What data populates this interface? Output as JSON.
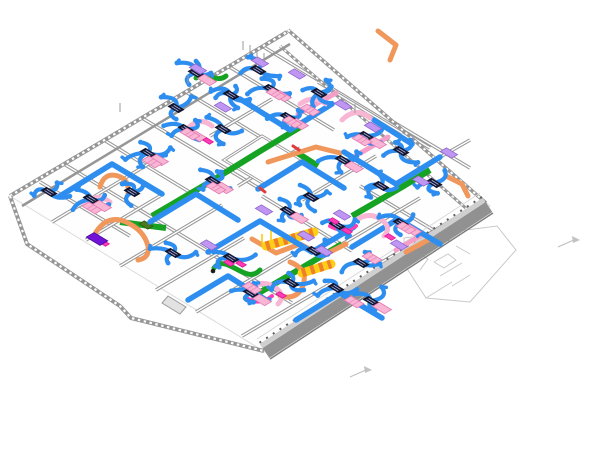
{
  "view": {
    "type": "3d-isometric-bim-mep-model",
    "width": 600,
    "height": 471,
    "background": "#ffffff"
  },
  "systems": [
    {
      "name": "flex-duct-supply",
      "color": "#2e8ef0"
    },
    {
      "name": "slot-diffuser-box",
      "color": "#14162e",
      "slot_color": "#aab4e8"
    },
    {
      "name": "hydronic-pipe-green",
      "color": "#16a323"
    },
    {
      "name": "conduit-orange",
      "color": "#f0975c"
    },
    {
      "name": "insulated-flex-duct",
      "color": "#ffcf18",
      "stripe": "#ef7f28"
    },
    {
      "name": "fan-coil-unit-pink",
      "color": "#f8b6d4",
      "stripe": "#ec8fc0",
      "edge": "#e277b2"
    },
    {
      "name": "vav-box-purple",
      "color": "#bf97f2",
      "edge": "#8f62cc"
    },
    {
      "name": "equipment-dark-purple",
      "color": "#7212d6",
      "edge": "#4d0a9e"
    },
    {
      "name": "accent-magenta",
      "color": "#ff3db2",
      "edge": "#d9179a"
    },
    {
      "name": "pink-duct-main",
      "color": "#f49fc8"
    },
    {
      "name": "equipment-olive",
      "color": "#4a7a1e",
      "edge": "#33550f"
    },
    {
      "name": "accent-red",
      "color": "#e03c3c"
    },
    {
      "name": "walls",
      "color": "#969696",
      "light": "#ffffff"
    },
    {
      "name": "parapet-band",
      "color": "#919191",
      "top": "#cfcfcf",
      "edge": "#7e7e7e"
    },
    {
      "name": "faint-outline",
      "color": "#c9c9c9"
    }
  ],
  "scene": {
    "floor": {
      "points": [
        [
          10,
          196
        ],
        [
          288,
          30
        ],
        [
          490,
          206
        ],
        [
          265,
          352
        ]
      ],
      "fill": "#fefefe",
      "edge": "#dcdcdc"
    },
    "shaft": {
      "points": [
        [
          224,
          160
        ],
        [
          262,
          136
        ],
        [
          302,
          160
        ],
        [
          264,
          184
        ]
      ],
      "fill": "#ffffff"
    },
    "walls_interior": [
      {
        "pts": [
          [
            64,
            164
          ],
          [
            206,
            250
          ]
        ]
      },
      {
        "pts": [
          [
            104,
            140
          ],
          [
            196,
            196
          ]
        ]
      },
      {
        "pts": [
          [
            142,
            118
          ],
          [
            262,
            190
          ]
        ]
      },
      {
        "pts": [
          [
            186,
            92
          ],
          [
            300,
            161
          ]
        ]
      },
      {
        "pts": [
          [
            228,
            66
          ],
          [
            334,
            130
          ]
        ]
      },
      {
        "pts": [
          [
            262,
            46
          ],
          [
            430,
            148
          ]
        ]
      },
      {
        "pts": [
          [
            318,
            82
          ],
          [
            402,
            133
          ]
        ]
      },
      {
        "pts": [
          [
            40,
            182
          ],
          [
            130,
            236
          ]
        ]
      },
      {
        "pts": [
          [
            208,
            252
          ],
          [
            292,
            303
          ]
        ]
      },
      {
        "pts": [
          [
            262,
            196
          ],
          [
            352,
            251
          ]
        ]
      },
      {
        "pts": [
          [
            360,
            186
          ],
          [
            450,
            240
          ]
        ]
      },
      {
        "pts": [
          [
            390,
            120
          ],
          [
            470,
            168
          ]
        ]
      },
      {
        "pts": [
          [
            52,
            222
          ],
          [
            150,
            163
          ]
        ]
      },
      {
        "pts": [
          [
            86,
            240
          ],
          [
            160,
            196
          ]
        ]
      },
      {
        "pts": [
          [
            120,
            266
          ],
          [
            222,
            205
          ]
        ]
      },
      {
        "pts": [
          [
            156,
            290
          ],
          [
            244,
            238
          ]
        ]
      },
      {
        "pts": [
          [
            196,
            312
          ],
          [
            300,
            250
          ]
        ]
      },
      {
        "pts": [
          [
            242,
            336
          ],
          [
            330,
            284
          ]
        ]
      },
      {
        "pts": [
          [
            160,
            108
          ],
          [
            226,
            68
          ]
        ]
      },
      {
        "pts": [
          [
            210,
            136
          ],
          [
            272,
            99
          ]
        ]
      },
      {
        "pts": [
          [
            238,
            186
          ],
          [
            300,
            148
          ]
        ]
      },
      {
        "pts": [
          [
            302,
            200
          ],
          [
            376,
            156
          ]
        ]
      },
      {
        "pts": [
          [
            332,
            250
          ],
          [
            420,
            198
          ]
        ]
      },
      {
        "pts": [
          [
            382,
            262
          ],
          [
            462,
            214
          ]
        ]
      },
      {
        "pts": [
          [
            414,
            172
          ],
          [
            470,
            140
          ]
        ]
      }
    ],
    "walls_perimeter": [
      {
        "pts": [
          [
            10,
            196
          ],
          [
            287,
            32
          ]
        ],
        "w": 4,
        "studs": true
      },
      {
        "pts": [
          [
            288,
            30
          ],
          [
            486,
            203
          ]
        ],
        "w": 3.5,
        "studs": true
      },
      {
        "pts": [
          [
            280,
            46
          ],
          [
            468,
            210
          ]
        ],
        "w": 3,
        "studs": true
      },
      {
        "pts": [
          [
            22,
            206
          ],
          [
            290,
            44
          ]
        ],
        "w": 2.5,
        "studs": false
      },
      {
        "pts": [
          [
            10,
            196
          ],
          [
            27,
            244
          ],
          [
            120,
            306
          ],
          [
            131,
            318
          ],
          [
            264,
            351
          ]
        ],
        "w": 4,
        "studs": true
      }
    ],
    "parapet": {
      "top_light": {
        "pts": [
          [
            484,
            200
          ],
          [
            261,
            346
          ]
        ],
        "w": 5,
        "color": "#cfcfcf"
      },
      "band": {
        "pts": [
          [
            489,
            207
          ],
          [
            266,
            353
          ]
        ],
        "w": 12,
        "color": "#919191"
      },
      "dark_edge": {
        "pts": [
          [
            493,
            213
          ],
          [
            270,
            359
          ]
        ],
        "w": 1.5,
        "color": "#7e7e7e"
      },
      "inner_ticks": {
        "pts": [
          [
            482,
            197
          ],
          [
            259,
            343
          ]
        ],
        "w": 2,
        "color": "#5f5f5f",
        "dash": "2,6"
      },
      "floor_line": {
        "pts": [
          [
            480,
            193
          ],
          [
            257,
            339
          ]
        ],
        "w": 1,
        "color": "#d8d8d8"
      }
    },
    "stub": {
      "points": [
        [
          168,
          296
        ],
        [
          186,
          307
        ],
        [
          180,
          314
        ],
        [
          162,
          303
        ]
      ],
      "fill": "#e2e2e2",
      "edge": "#9a9a9a"
    },
    "pipes_green": [
      [
        [
          152,
          216
        ],
        [
          210,
          182
        ],
        [
          262,
          150
        ],
        [
          302,
          126
        ]
      ],
      [
        [
          252,
          297
        ],
        [
          300,
          269
        ],
        [
          342,
          244
        ]
      ],
      [
        [
          352,
          216
        ],
        [
          402,
          187
        ],
        [
          430,
          170
        ]
      ],
      [
        [
          120,
          222
        ],
        [
          166,
          228
        ]
      ],
      [
        [
          296,
          152
        ],
        [
          318,
          166
        ]
      ]
    ],
    "green_curls": [
      "M214,268 C226,252 246,286 260,270",
      "M196,78 C206,70 216,84 226,76"
    ],
    "olive_boxes": [
      [
        146,
        225
      ]
    ],
    "pipes_orange": [
      [
        [
          268,
          162
        ],
        [
          316,
          147
        ],
        [
          340,
          153
        ]
      ],
      [
        [
          252,
          239
        ],
        [
          276,
          253
        ],
        [
          300,
          244
        ],
        [
          322,
          256
        ],
        [
          346,
          244
        ]
      ],
      [
        [
          378,
          31
        ],
        [
          396,
          45
        ],
        [
          390,
          60
        ]
      ],
      [
        [
          446,
          176
        ],
        [
          462,
          184
        ],
        [
          468,
          196
        ]
      ],
      [
        [
          406,
          252
        ],
        [
          428,
          240
        ]
      ]
    ],
    "orange_curls": [
      "M96,232 Q108,214 126,222 Q144,230 148,246 Q150,258 138,260",
      "M290,262 Q310,270 302,288 Q296,300 280,296",
      "M100,187 Q104,172 118,176 Q130,180 128,194"
    ],
    "pink_mains": [
      [
        [
          298,
          114
        ],
        [
          336,
          93
        ]
      ],
      [
        [
          352,
          158
        ],
        [
          388,
          137
        ]
      ],
      [
        [
          396,
          250
        ],
        [
          420,
          236
        ]
      ]
    ],
    "striped_ducts": [
      [
        [
          266,
          246
        ],
        [
          314,
          232
        ]
      ],
      [
        [
          302,
          273
        ],
        [
          331,
          264
        ]
      ]
    ],
    "hangers": [
      [
        262,
        234,
        262,
        246
      ],
      [
        271,
        230,
        271,
        242
      ]
    ],
    "pipes_blue": [
      [
        [
          60,
          196
        ],
        [
          112,
          164
        ],
        [
          162,
          194
        ]
      ],
      [
        [
          240,
          99
        ],
        [
          290,
          130
        ],
        [
          332,
          104
        ]
      ],
      [
        [
          344,
          152
        ],
        [
          396,
          184
        ],
        [
          440,
          157
        ]
      ],
      [
        [
          208,
          252
        ],
        [
          260,
          221
        ],
        [
          312,
          252
        ],
        [
          354,
          227
        ]
      ],
      [
        [
          258,
          189
        ],
        [
          302,
          162
        ],
        [
          344,
          188
        ]
      ],
      [
        [
          352,
          247
        ],
        [
          398,
          219
        ],
        [
          440,
          244
        ]
      ],
      [
        [
          150,
          222
        ],
        [
          196,
          194
        ],
        [
          238,
          220
        ]
      ],
      [
        [
          296,
          320
        ],
        [
          340,
          293
        ],
        [
          382,
          318
        ]
      ],
      [
        [
          374,
          120
        ],
        [
          412,
          144
        ]
      ],
      [
        [
          188,
          300
        ],
        [
          228,
          276
        ],
        [
          266,
          300
        ]
      ]
    ],
    "pink_flex": [
      "M250,290 Q262,278 276,288 Q286,296 278,304",
      "M188,128 Q200,116 212,126",
      "M354,222 Q368,210 382,220 Q392,228 384,236",
      "M342,120 Q356,106 370,118",
      "M84,204 Q96,192 110,202",
      "M300,104 Q314,94 326,104"
    ],
    "magenta_flex": [
      "M246,298 Q260,306 272,296",
      "M330,226 Q344,234 356,226"
    ],
    "clusters": [
      [
        196,
        73,
        4,
        "p"
      ],
      [
        231,
        95,
        5,
        ""
      ],
      [
        186,
        129,
        4,
        "p"
      ],
      [
        148,
        153,
        5,
        "p"
      ],
      [
        91,
        199,
        4,
        "p"
      ],
      [
        49,
        192,
        3,
        ""
      ],
      [
        176,
        108,
        3,
        ""
      ],
      [
        271,
        89,
        3,
        "p"
      ],
      [
        288,
        117,
        3,
        "p"
      ],
      [
        319,
        93,
        5,
        ""
      ],
      [
        366,
        136,
        3,
        "p"
      ],
      [
        401,
        151,
        4,
        ""
      ],
      [
        381,
        186,
        4,
        ""
      ],
      [
        311,
        197,
        4,
        ""
      ],
      [
        401,
        223,
        4,
        "p"
      ],
      [
        337,
        225,
        3,
        "m"
      ],
      [
        213,
        181,
        4,
        "p"
      ],
      [
        173,
        253,
        4,
        ""
      ],
      [
        231,
        258,
        3,
        "m"
      ],
      [
        251,
        293,
        4,
        "p"
      ],
      [
        291,
        283,
        4,
        ""
      ],
      [
        361,
        263,
        3,
        ""
      ],
      [
        371,
        301,
        3,
        "p"
      ],
      [
        336,
        288,
        3,
        ""
      ],
      [
        434,
        183,
        3,
        ""
      ],
      [
        223,
        129,
        3,
        ""
      ],
      [
        314,
        251,
        3,
        ""
      ],
      [
        132,
        192,
        3,
        ""
      ],
      [
        258,
        70,
        3,
        ""
      ],
      [
        343,
        160,
        3,
        "p"
      ],
      [
        288,
        211,
        3,
        "p"
      ]
    ],
    "pink_units": [
      [
        152,
        162
      ],
      [
        92,
        208
      ],
      [
        190,
        134
      ],
      [
        276,
        94
      ],
      [
        292,
        122
      ],
      [
        362,
        140
      ],
      [
        406,
        228
      ],
      [
        354,
        302
      ],
      [
        216,
        188
      ],
      [
        252,
        288
      ],
      [
        310,
        110
      ],
      [
        372,
        258
      ]
    ],
    "purple_boxes": [
      [
        198,
        69
      ],
      [
        223,
        107
      ],
      [
        297,
        74
      ],
      [
        343,
        105
      ],
      [
        421,
        181
      ],
      [
        342,
        215
      ],
      [
        324,
        251
      ],
      [
        209,
        245
      ],
      [
        373,
        127
      ],
      [
        399,
        245
      ],
      [
        449,
        153
      ],
      [
        260,
        62
      ],
      [
        306,
        236
      ],
      [
        264,
        210
      ]
    ],
    "magenta_chips": [
      [
        390,
        237
      ],
      [
        334,
        221
      ],
      [
        229,
        263
      ],
      [
        281,
        295
      ],
      [
        208,
        141
      ],
      [
        104,
        243
      ]
    ],
    "dark_purple_box": [
      97,
      239
    ],
    "red_chips": [
      [
        293,
        146,
        299,
        150
      ],
      [
        260,
        188,
        265,
        192
      ]
    ],
    "black_dots": [
      [
        213,
        271
      ]
    ],
    "grid_ticks": [
      [
        243,
        50
      ],
      [
        250,
        54
      ],
      [
        257,
        58
      ],
      [
        264,
        62
      ],
      [
        120,
        112
      ],
      [
        188,
        84
      ],
      [
        355,
        113
      ]
    ],
    "markers": [
      {
        "line": [
          [
            558,
            247
          ],
          [
            576,
            239
          ]
        ],
        "flag": [
          [
            572,
            236
          ],
          [
            580,
            240
          ],
          [
            573,
            243
          ]
        ]
      },
      {
        "line": [
          [
            350,
            377
          ],
          [
            368,
            369
          ]
        ],
        "flag": [
          [
            364,
            366
          ],
          [
            372,
            370
          ],
          [
            365,
            373
          ]
        ]
      }
    ],
    "wing": {
      "outer": [
        [
          404,
          238
        ],
        [
          497,
          226
        ],
        [
          516,
          250
        ],
        [
          470,
          302
        ],
        [
          426,
          298
        ],
        [
          404,
          264
        ]
      ],
      "lines": [
        [
          [
            404,
            264
          ],
          [
            430,
            249
          ]
        ],
        [
          [
            426,
            298
          ],
          [
            452,
            282
          ]
        ],
        [
          [
            440,
            276
          ],
          [
            462,
            263
          ]
        ],
        [
          [
            452,
            286
          ],
          [
            470,
            275
          ]
        ],
        [
          [
            416,
            252
          ],
          [
            428,
            259
          ],
          [
            420,
            270
          ]
        ],
        [
          [
            456,
            246
          ],
          [
            470,
            254
          ]
        ],
        [
          [
            434,
            262
          ],
          [
            448,
            254
          ],
          [
            456,
            260
          ],
          [
            444,
            268
          ],
          [
            434,
            262
          ]
        ]
      ]
    }
  }
}
